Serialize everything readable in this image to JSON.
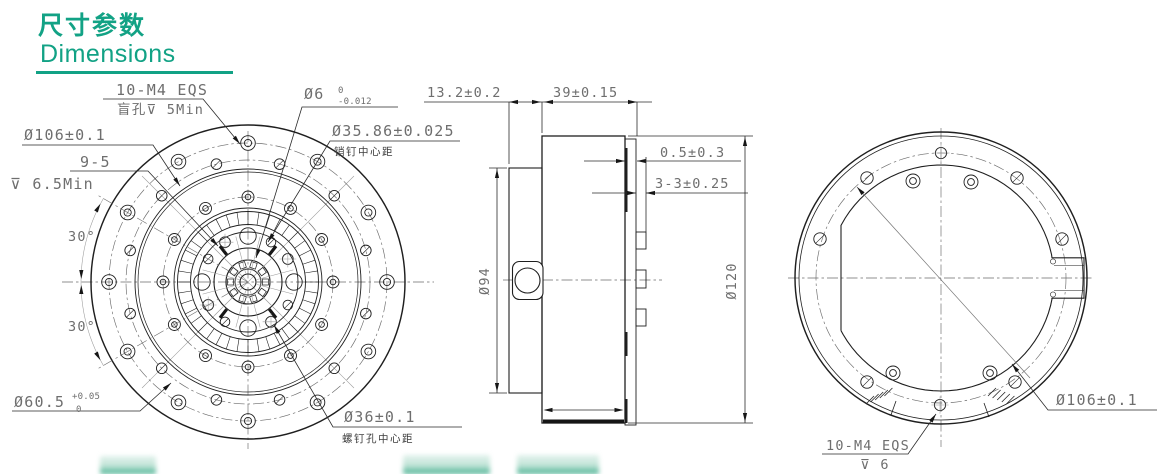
{
  "header": {
    "title_zh": "尺寸参数",
    "title_en": "Dimensions",
    "accent_color": "#12a285",
    "watermark_green": "#31a884"
  },
  "front_view": {
    "bolt_callout": "10-M4 EQS",
    "bolt_note": "盲孔⊽ 5Min",
    "shaft_dia": "Ø6",
    "shaft_tol_upper": "0",
    "shaft_tol_lower": "-0.012",
    "pin_circle_dia": "Ø35.86±0.025",
    "pin_note": "销钉中心距",
    "flange_bolt_circle_dia": "Ø106±0.1",
    "hole_count": "9-5",
    "hole_depth": "⊽ 6.5Min",
    "angle_upper": "30°",
    "angle_lower": "30°",
    "spigot_dia": "Ø60.5",
    "spigot_tol_upper": "+0.05",
    "spigot_tol_lower": "0",
    "screw_circle_dia": "Ø36±0.1",
    "screw_note": "螺钉孔中心距"
  },
  "side_view": {
    "flange_width": "13.2±0.2",
    "body_width": "39±0.15",
    "gap": "0.5±0.3",
    "tab": "3-3±0.25",
    "flange_dia": "Ø94",
    "body_dia": "Ø120"
  },
  "back_view": {
    "bolt_circle_dia": "Ø106±0.1",
    "bolt_callout": "10-M4 EQS",
    "bolt_depth": "⊽ 6"
  }
}
